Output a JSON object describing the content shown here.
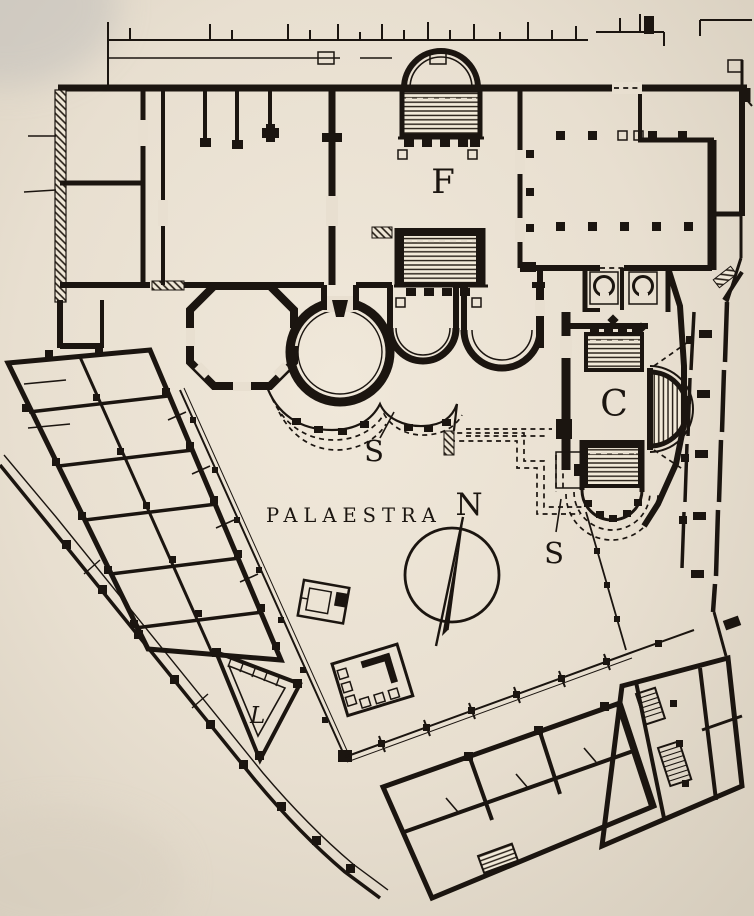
{
  "document": {
    "type": "architectural-floor-plan",
    "description": "Scanned engraved floor plan of a Roman bath complex with palaestra, bathing block, porticoes and surrounding street blocks"
  },
  "labels": {
    "f": "F",
    "c": "C",
    "s_upper": "S",
    "s_lower": "S",
    "palaestra": "PALAESTRA",
    "n": "N",
    "l": "L"
  },
  "colors": {
    "ink": "#1b1510",
    "paper": "#e8dfd0",
    "paper_light": "#f0e8da",
    "paper_shadow": "#cfc8ba",
    "pool_fill": "#f2ead9"
  }
}
